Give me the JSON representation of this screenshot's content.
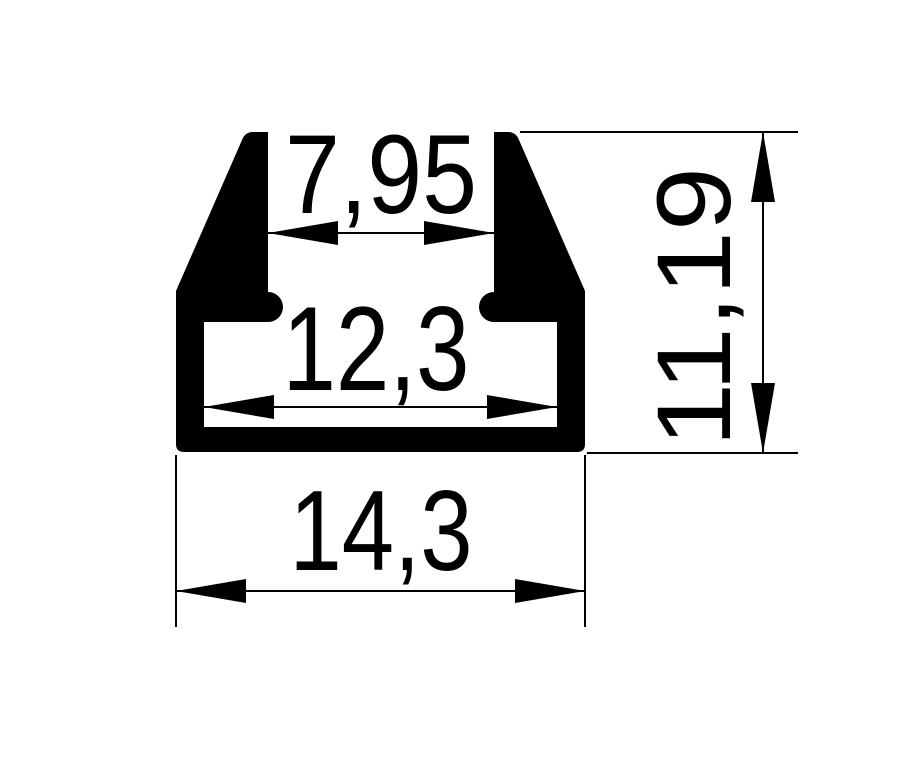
{
  "page": {
    "background_color": "#ffffff",
    "ink_color": "#000000"
  },
  "drawing": {
    "kind": "profile-cross-section",
    "labels": {
      "top_opening": "7,95",
      "inner_width": "12,3",
      "overall_width": "14,3",
      "overall_height": "11,19"
    },
    "values": {
      "top_opening": 7.95,
      "inner_width": 12.3,
      "overall_width": 14.3,
      "overall_height": 11.19
    }
  }
}
